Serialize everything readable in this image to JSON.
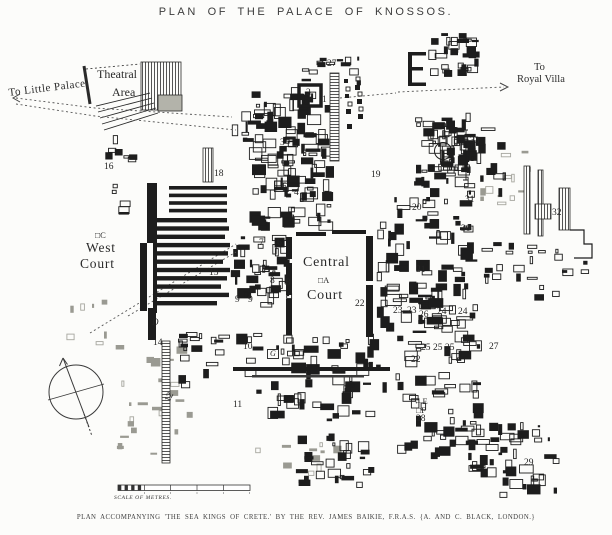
{
  "title": "PLAN OF THE PALACE OF KNOSSOS.",
  "caption": "PLAN ACCOMPANYING 'THE SEA KINGS OF CRETE.'   BY THE REV. JAMES BAIKIE, F.R.A.S.   {A. AND C. BLACK, LONDON.}",
  "colors": {
    "ink": "#1d1d1d",
    "paper": "#fcfcfa",
    "gray_ruin": "#9a9a92",
    "shade_block": "#b3b3aa"
  },
  "map": {
    "labels": [
      {
        "text": "To Little Palace",
        "x": 8,
        "y": 88,
        "cls": "place",
        "size": 11,
        "rot": -7,
        "sp": 0.5,
        "name": "place-label-to-little-palace"
      },
      {
        "text": "Theatral",
        "x": 97,
        "y": 68,
        "cls": "place",
        "size": 12,
        "name": "place-label-theatral"
      },
      {
        "text": "Area",
        "x": 112,
        "y": 86,
        "cls": "place",
        "size": 12,
        "name": "place-label-theatral-area"
      },
      {
        "text": "To",
        "x": 534,
        "y": 63,
        "cls": "place",
        "size": 10.5,
        "name": "place-label-to-royal-villa"
      },
      {
        "text": "Royal Villa",
        "x": 517,
        "y": 75,
        "cls": "place",
        "size": 10.5,
        "name": "place-label-royal-villa"
      },
      {
        "text": "West",
        "x": 86,
        "y": 241,
        "cls": "place-lg",
        "name": "place-label-west-court"
      },
      {
        "text": "Court",
        "x": 80,
        "y": 257,
        "cls": "place-lg",
        "name": "place-label-west-court-2"
      },
      {
        "text": "Central",
        "x": 303,
        "y": 256,
        "cls": "place-lg",
        "size": 14,
        "name": "place-label-central-court"
      },
      {
        "text": "Court",
        "x": 307,
        "y": 289,
        "cls": "place-lg",
        "size": 14,
        "name": "place-label-central-court-2"
      },
      {
        "text": "□A",
        "x": 318,
        "y": 276,
        "cls": "marker",
        "name": "marker-a"
      },
      {
        "text": "□C",
        "x": 95,
        "y": 231,
        "cls": "marker",
        "name": "marker-c"
      },
      {
        "text": "B",
        "x": 285,
        "y": 278,
        "cls": "letter",
        "name": "marker-b"
      },
      {
        "text": "D",
        "x": 152,
        "y": 318,
        "cls": "letter",
        "name": "marker-d"
      },
      {
        "text": "←E",
        "x": 414,
        "y": 397,
        "cls": "marker",
        "name": "marker-e"
      },
      {
        "text": "□F",
        "x": 416,
        "y": 406,
        "cls": "marker",
        "name": "marker-f"
      },
      {
        "text": "G",
        "x": 267,
        "y": 349,
        "cls": "boxed",
        "name": "marker-g"
      },
      {
        "text": "SCALE OF METRES.",
        "x": 114,
        "y": 496,
        "cls": "tiny",
        "sp": 0.6,
        "name": "scale-bar-label"
      },
      {
        "text": "27",
        "x": 327,
        "y": 60
      },
      {
        "text": "2",
        "x": 306,
        "y": 89
      },
      {
        "text": "1",
        "x": 322,
        "y": 96
      },
      {
        "text": "3",
        "x": 280,
        "y": 139
      },
      {
        "text": "16",
        "x": 104,
        "y": 163
      },
      {
        "text": "18",
        "x": 214,
        "y": 170
      },
      {
        "text": "5",
        "x": 282,
        "y": 183
      },
      {
        "text": "4",
        "x": 294,
        "y": 189
      },
      {
        "text": "33",
        "x": 470,
        "y": 137
      },
      {
        "text": "19",
        "x": 371,
        "y": 171
      },
      {
        "text": "31",
        "x": 465,
        "y": 196
      },
      {
        "text": "20",
        "x": 412,
        "y": 204
      },
      {
        "text": "32",
        "x": 552,
        "y": 209
      },
      {
        "text": "30",
        "x": 461,
        "y": 225
      },
      {
        "text": "15",
        "x": 209,
        "y": 269
      },
      {
        "text": "7",
        "x": 259,
        "y": 239
      },
      {
        "text": "6",
        "x": 277,
        "y": 239
      },
      {
        "text": "8",
        "x": 270,
        "y": 277
      },
      {
        "text": "9",
        "x": 235,
        "y": 296
      },
      {
        "text": "9",
        "x": 248,
        "y": 296
      },
      {
        "text": "22",
        "x": 355,
        "y": 300
      },
      {
        "text": "21",
        "x": 416,
        "y": 266
      },
      {
        "text": "10",
        "x": 243,
        "y": 343
      },
      {
        "text": "14",
        "x": 153,
        "y": 339
      },
      {
        "text": "23",
        "x": 393,
        "y": 307
      },
      {
        "text": "23",
        "x": 407,
        "y": 307
      },
      {
        "text": "26",
        "x": 419,
        "y": 311
      },
      {
        "text": "24",
        "x": 437,
        "y": 308
      },
      {
        "text": "24",
        "x": 458,
        "y": 308
      },
      {
        "text": "25",
        "x": 421,
        "y": 344
      },
      {
        "text": "25",
        "x": 433,
        "y": 344
      },
      {
        "text": "25",
        "x": 445,
        "y": 344
      },
      {
        "text": "22",
        "x": 411,
        "y": 356
      },
      {
        "text": "27",
        "x": 489,
        "y": 343
      },
      {
        "text": "28",
        "x": 416,
        "y": 415
      },
      {
        "text": "29",
        "x": 524,
        "y": 459
      },
      {
        "text": "11",
        "x": 233,
        "y": 401
      },
      {
        "text": "12",
        "x": 164,
        "y": 400,
        "rot": -65
      }
    ]
  }
}
